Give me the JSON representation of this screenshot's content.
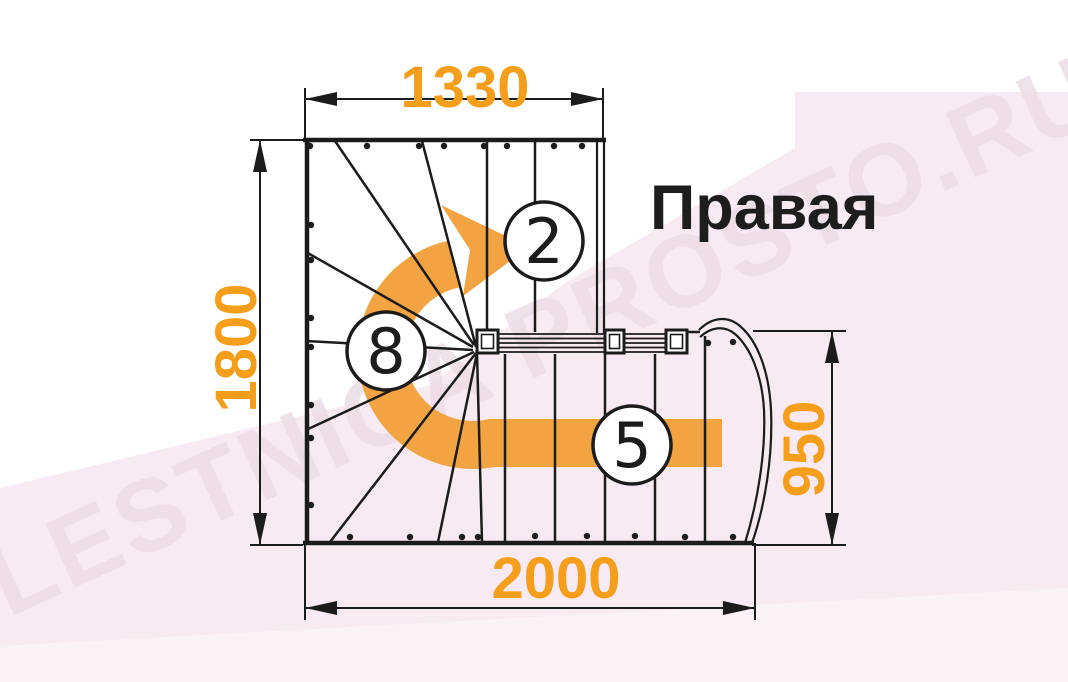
{
  "title": {
    "label": "Правая"
  },
  "watermark": {
    "text": "LESTNICA PROSTO.RU"
  },
  "colors": {
    "dimension_text": "#F59E1B",
    "arrow": "#F2A342",
    "line": "#1C1C1C",
    "title_text": "#1D1D1D",
    "background_pink": "#F8EAF2",
    "background_pink_light": "#FBF2F7",
    "watermark": "#EBDCE5"
  },
  "dimensions": {
    "top": "1330",
    "left": "1800",
    "right": "950",
    "bottom": "2000"
  },
  "step_labels": {
    "upper_flight": "2",
    "winder": "8",
    "lower_flight": "5"
  }
}
